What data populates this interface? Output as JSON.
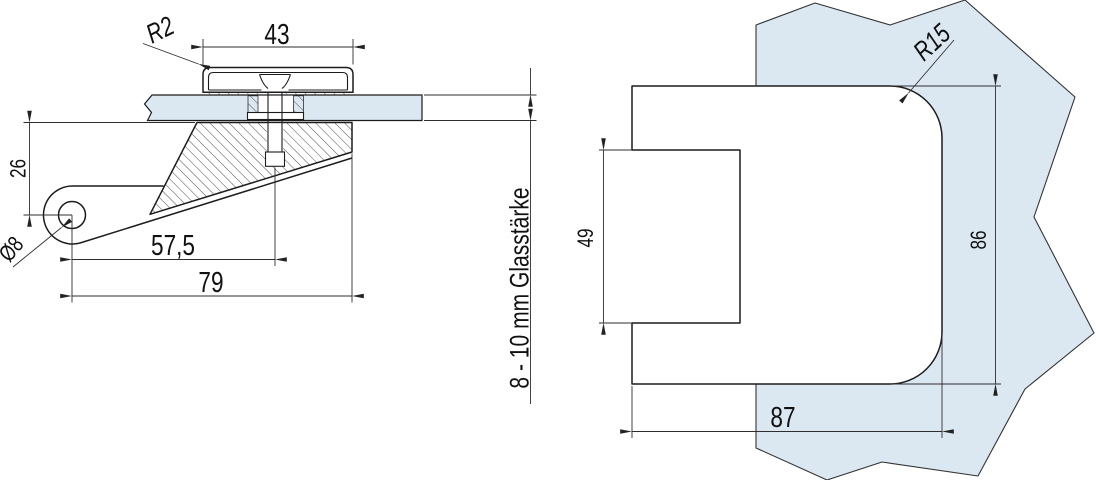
{
  "dims": {
    "cap_width": "43",
    "cap_corner_radius": "R2",
    "pivot_height": "26",
    "pivot_hole_diameter": "Ø8",
    "screw_axis_offset": "57,5",
    "overall_length": "79",
    "glass_thickness_note": "8 - 10 mm Glasstärke",
    "body_corner_radius": "R15",
    "notch_height": "49",
    "body_height": "86",
    "body_width": "87"
  },
  "colors": {
    "glass_fill": "#dce8f1",
    "outline": "#1c1c1c",
    "dimension_line": "#2e2e2e",
    "background": "#ffffff"
  }
}
